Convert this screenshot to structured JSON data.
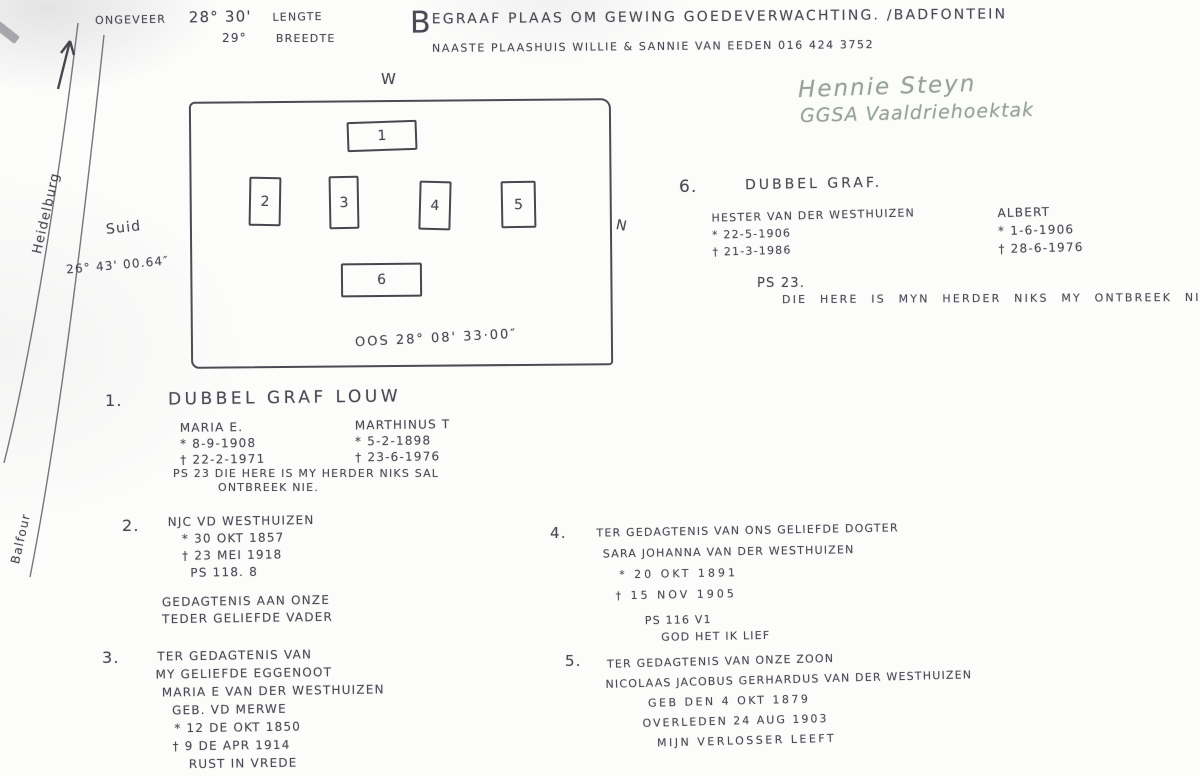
{
  "header": {
    "ongeveer": "ONGEVEER",
    "longitude": "28° 30'",
    "lengte": "LENGTE",
    "latitude": "29°",
    "breedte": "BREEDTE",
    "title_initial": "B",
    "title_rest": "EGRAAF PLAAS OM GEWING GOEDEVERWACHTING. /BADFONTEIN",
    "subtitle": "NAASTE PLAASHUIS   WILLIE & SANNIE VAN EEDEN    016 424 3752",
    "annotator_name": "Hennie Steyn",
    "annotator_org": "GGSA Vaaldriehoektak"
  },
  "roads": {
    "north_label": "Heidelburg",
    "south_label": "Balfour"
  },
  "map": {
    "west": "W",
    "north": "N",
    "south": "Suid",
    "south_coord": "26° 43' 00.64″",
    "east_coord": "OOS  28° 08' 33·00″",
    "plots": [
      "1",
      "2",
      "3",
      "4",
      "5",
      "6"
    ]
  },
  "entries": {
    "e1": {
      "num": "1.",
      "title": "DUBBEL GRAF LOUW",
      "left": [
        "MARIA E.",
        "* 8-9-1908",
        "† 22-2-1971"
      ],
      "right": [
        "MARTHINUS T",
        "* 5-2-1898",
        "† 23-6-1976"
      ],
      "verse1": "PS 23  DIE HERE IS MY HERDER NIKS SAL",
      "verse2": "ONTBREEK NIE."
    },
    "e2": {
      "num": "2.",
      "lines": [
        "NJC VD WESTHUIZEN",
        "* 30 OKT 1857",
        "† 23 MEI 1918",
        "PS 118. 8"
      ],
      "lines2": [
        "GEDAGTENIS AAN ONZE",
        "TEDER GELIEFDE VADER"
      ]
    },
    "e3": {
      "num": "3.",
      "lines": [
        "TER GEDAGTENIS VAN",
        "MY GELIEFDE EGGENOOT",
        "MARIA E VAN DER WESTHUIZEN",
        "GEB. VD MERWE",
        "* 12 DE OKT 1850",
        "† 9 DE APR 1914",
        "RUST IN VREDE"
      ]
    },
    "e4": {
      "num": "4.",
      "lines": [
        "TER GEDAGTENIS VAN ONS GELIEFDE DOGTER",
        "SARA JOHANNA VAN DER WESTHUIZEN",
        "* 20 OKT 1891",
        "† 15 NOV 1905"
      ],
      "lines2": [
        "PS 116 V1",
        "GOD HET IK LIEF"
      ]
    },
    "e5": {
      "num": "5.",
      "lines": [
        "TER GEDAGTENIS VAN ONZE ZOON",
        "NICOLAAS JACOBUS GERHARDUS VAN DER WESTHUIZEN",
        "GEB DEN 4 OKT 1879",
        "OVERLEDEN 24 AUG 1903",
        "MIJN VERLOSSER LEEFT"
      ]
    },
    "e6": {
      "num": "6.",
      "title": "DUBBEL GRAF.",
      "left": [
        "HESTER VAN DER WESTHUIZEN",
        "* 22-5-1906",
        "† 21-3-1986"
      ],
      "right": [
        "ALBERT",
        "* 1-6-1906",
        "† 28-6-1976"
      ],
      "verse1": "PS 23.",
      "verse2": "DIE HERE IS MYN HERDER NIKS MY ONTBREEK NIE"
    }
  }
}
